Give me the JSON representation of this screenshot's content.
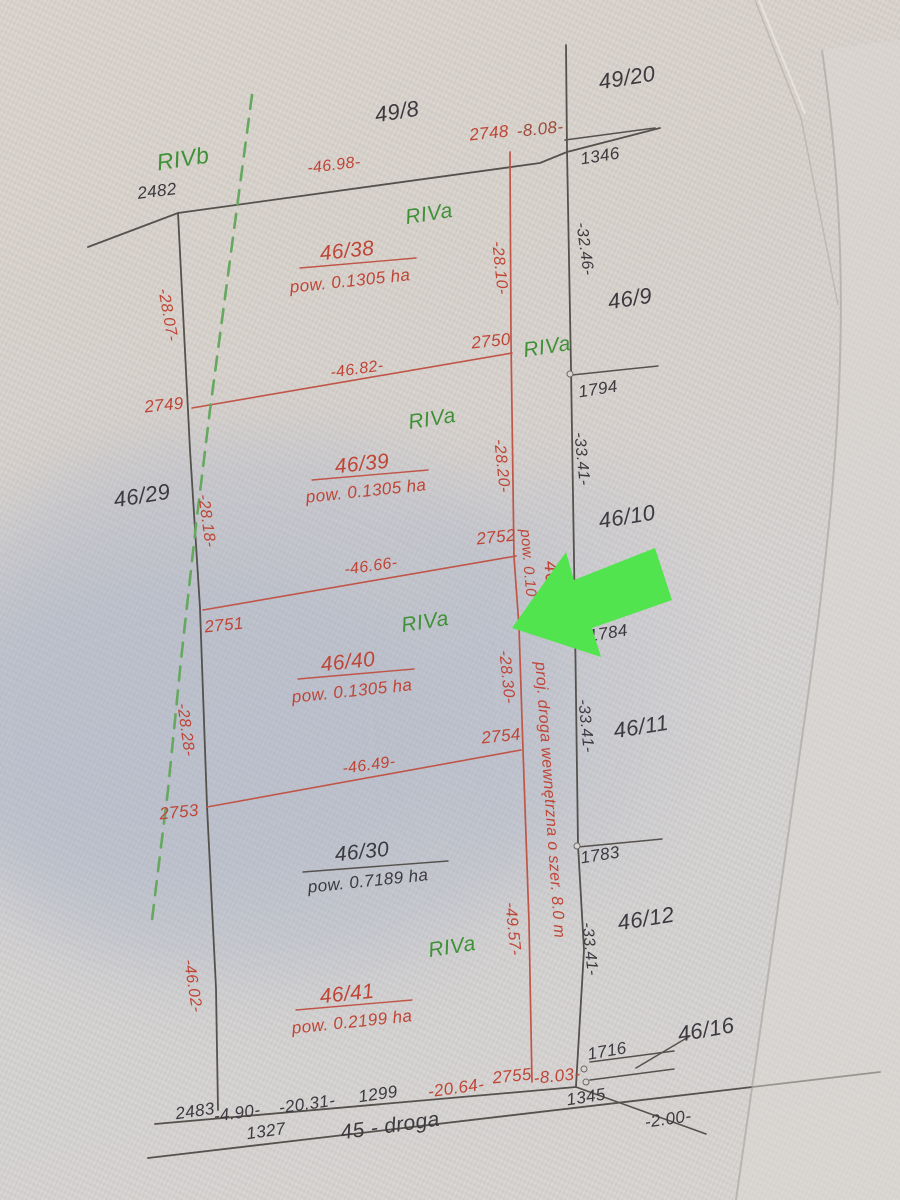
{
  "map": {
    "description": "Photographed cadastral division sketch of parcels 46/38-46/41 along road 45 - droga",
    "colors": {
      "black": "#3c3a40",
      "red": "#bf4536",
      "dkred": "#9e4a3b",
      "green": "#3f9138",
      "lineBlack": "#55514d",
      "lineRed": "#c05548",
      "dashGreen": "#67a861",
      "arrow": "#52e44e",
      "junctionFill": "#d8d4cf",
      "junctionStroke": "#6b6762"
    },
    "labels": [
      {
        "t": "49/20",
        "x": 627,
        "y": 78,
        "r": -9,
        "c": "black",
        "s": 22
      },
      {
        "t": "49/8",
        "x": 397,
        "y": 112,
        "r": -9,
        "c": "black",
        "s": 22
      },
      {
        "t": "2748",
        "x": 489,
        "y": 133,
        "r": -6,
        "c": "red",
        "s": 17
      },
      {
        "t": "-8.08-",
        "x": 540,
        "y": 129,
        "r": -6,
        "c": "dkred",
        "s": 17
      },
      {
        "t": "1346",
        "x": 600,
        "y": 156,
        "r": -9,
        "c": "black",
        "s": 17
      },
      {
        "t": "RIVb",
        "x": 183,
        "y": 159,
        "r": -9,
        "c": "green",
        "s": 23
      },
      {
        "t": "2482",
        "x": 157,
        "y": 191,
        "r": -7,
        "c": "black",
        "s": 17
      },
      {
        "t": "-46.98-",
        "x": 334,
        "y": 166,
        "r": -7,
        "c": "red",
        "s": 16
      },
      {
        "t": "RIVa",
        "x": 429,
        "y": 214,
        "r": -9,
        "c": "green",
        "s": 21
      },
      {
        "t": "46/38",
        "x": 347,
        "y": 251,
        "r": -6,
        "c": "red",
        "s": 21
      },
      {
        "t": "pow. 0.1305 ha",
        "x": 350,
        "y": 281,
        "r": -6,
        "c": "red",
        "s": 17
      },
      {
        "t": "-28.10-",
        "x": 499,
        "y": 268,
        "r": 84,
        "c": "red",
        "s": 16
      },
      {
        "t": "-32.46-",
        "x": 584,
        "y": 249,
        "r": 82,
        "c": "black",
        "s": 16
      },
      {
        "t": "46/9",
        "x": 630,
        "y": 299,
        "r": -9,
        "c": "black",
        "s": 22
      },
      {
        "t": "-28.07-",
        "x": 167,
        "y": 315,
        "r": 80,
        "c": "red",
        "s": 16
      },
      {
        "t": "2750",
        "x": 491,
        "y": 341,
        "r": -6,
        "c": "red",
        "s": 17
      },
      {
        "t": "RIVa",
        "x": 547,
        "y": 347,
        "r": -9,
        "c": "green",
        "s": 21
      },
      {
        "t": "1794",
        "x": 598,
        "y": 389,
        "r": -9,
        "c": "black",
        "s": 17
      },
      {
        "t": "2749",
        "x": 164,
        "y": 405,
        "r": -6,
        "c": "red",
        "s": 17
      },
      {
        "t": "-46.82-",
        "x": 357,
        "y": 370,
        "r": -8,
        "c": "red",
        "s": 16
      },
      {
        "t": "RIVa",
        "x": 432,
        "y": 419,
        "r": -9,
        "c": "green",
        "s": 21
      },
      {
        "t": "46/39",
        "x": 362,
        "y": 464,
        "r": -6,
        "c": "red",
        "s": 21
      },
      {
        "t": "pow. 0.1305 ha",
        "x": 366,
        "y": 491,
        "r": -6,
        "c": "red",
        "s": 17
      },
      {
        "t": "-28.20-",
        "x": 501,
        "y": 466,
        "r": 84,
        "c": "red",
        "s": 16
      },
      {
        "t": "-33.41-",
        "x": 581,
        "y": 459,
        "r": 84,
        "c": "black",
        "s": 16
      },
      {
        "t": "46/29",
        "x": 142,
        "y": 496,
        "r": -9,
        "c": "black",
        "s": 22
      },
      {
        "t": "-28.18-",
        "x": 206,
        "y": 521,
        "r": 82,
        "c": "red",
        "s": 16
      },
      {
        "t": "46/10",
        "x": 627,
        "y": 517,
        "r": -9,
        "c": "black",
        "s": 22
      },
      {
        "t": "2752",
        "x": 496,
        "y": 537,
        "r": -6,
        "c": "red",
        "s": 17
      },
      {
        "t": "pow. 0.10",
        "x": 528,
        "y": 563,
        "r": 85,
        "c": "red",
        "s": 15
      },
      {
        "t": "46/3",
        "x": 552,
        "y": 581,
        "r": 85,
        "c": "red",
        "s": 20
      },
      {
        "t": "-46.66-",
        "x": 371,
        "y": 567,
        "r": -8,
        "c": "red",
        "s": 16
      },
      {
        "t": "2751",
        "x": 224,
        "y": 625,
        "r": -6,
        "c": "red",
        "s": 17
      },
      {
        "t": "1784",
        "x": 608,
        "y": 633,
        "r": -9,
        "c": "black",
        "s": 17
      },
      {
        "t": "RIVa",
        "x": 425,
        "y": 622,
        "r": -9,
        "c": "green",
        "s": 21
      },
      {
        "t": "-28.30-",
        "x": 506,
        "y": 677,
        "r": 84,
        "c": "red",
        "s": 16
      },
      {
        "t": "proj. droga wewnętrzna o szer. 8.0 m",
        "x": 549,
        "y": 800,
        "r": 86,
        "c": "red",
        "s": 16
      },
      {
        "t": "46/40",
        "x": 348,
        "y": 662,
        "r": -6,
        "c": "red",
        "s": 21
      },
      {
        "t": "pow. 0.1305 ha",
        "x": 352,
        "y": 691,
        "r": -6,
        "c": "red",
        "s": 17
      },
      {
        "t": "-28.28-",
        "x": 185,
        "y": 730,
        "r": 82,
        "c": "red",
        "s": 16
      },
      {
        "t": "-33.41-",
        "x": 585,
        "y": 726,
        "r": 84,
        "c": "black",
        "s": 16
      },
      {
        "t": "46/11",
        "x": 641,
        "y": 727,
        "r": -9,
        "c": "black",
        "s": 22
      },
      {
        "t": "2754",
        "x": 501,
        "y": 736,
        "r": -6,
        "c": "red",
        "s": 17
      },
      {
        "t": "-46.49-",
        "x": 369,
        "y": 766,
        "r": -8,
        "c": "red",
        "s": 16
      },
      {
        "t": "2753",
        "x": 179,
        "y": 812,
        "r": -6,
        "c": "red",
        "s": 17
      },
      {
        "t": "46/30",
        "x": 362,
        "y": 852,
        "r": -6,
        "c": "black",
        "s": 21
      },
      {
        "t": "pow. 0.7189 ha",
        "x": 368,
        "y": 881,
        "r": -6,
        "c": "black",
        "s": 17
      },
      {
        "t": "1783",
        "x": 600,
        "y": 855,
        "r": -9,
        "c": "black",
        "s": 17
      },
      {
        "t": "-49.57-",
        "x": 512,
        "y": 929,
        "r": 84,
        "c": "red",
        "s": 16
      },
      {
        "t": "46/12",
        "x": 646,
        "y": 919,
        "r": -9,
        "c": "black",
        "s": 22
      },
      {
        "t": "-33.41-",
        "x": 589,
        "y": 949,
        "r": 84,
        "c": "black",
        "s": 16
      },
      {
        "t": "RIVa",
        "x": 452,
        "y": 947,
        "r": -9,
        "c": "green",
        "s": 21
      },
      {
        "t": "-46.02-",
        "x": 192,
        "y": 986,
        "r": 81,
        "c": "red",
        "s": 16
      },
      {
        "t": "46/41",
        "x": 347,
        "y": 994,
        "r": -6,
        "c": "red",
        "s": 21
      },
      {
        "t": "pow. 0.2199 ha",
        "x": 352,
        "y": 1022,
        "r": -6,
        "c": "red",
        "s": 17
      },
      {
        "t": "1716",
        "x": 607,
        "y": 1051,
        "r": -10,
        "c": "black",
        "s": 17
      },
      {
        "t": "46/16",
        "x": 706,
        "y": 1030,
        "r": -10,
        "c": "black",
        "s": 22
      },
      {
        "t": "2755",
        "x": 512,
        "y": 1076,
        "r": -6,
        "c": "red",
        "s": 17
      },
      {
        "t": "-8.03-",
        "x": 557,
        "y": 1076,
        "r": -6,
        "c": "red",
        "s": 17
      },
      {
        "t": "1345",
        "x": 586,
        "y": 1097,
        "r": -9,
        "c": "black",
        "s": 17
      },
      {
        "t": "-20.64-",
        "x": 456,
        "y": 1088,
        "r": -8,
        "c": "red",
        "s": 17
      },
      {
        "t": "1299",
        "x": 378,
        "y": 1094,
        "r": -8,
        "c": "black",
        "s": 17
      },
      {
        "t": "-20.31-",
        "x": 307,
        "y": 1104,
        "r": -8,
        "c": "black",
        "s": 17
      },
      {
        "t": "-4.90-",
        "x": 237,
        "y": 1113,
        "r": -8,
        "c": "black",
        "s": 17
      },
      {
        "t": "2483",
        "x": 195,
        "y": 1111,
        "r": -8,
        "c": "black",
        "s": 17
      },
      {
        "t": "1327",
        "x": 266,
        "y": 1131,
        "r": -8,
        "c": "black",
        "s": 17
      },
      {
        "t": "45 - droga",
        "x": 390,
        "y": 1126,
        "r": -8,
        "c": "black",
        "s": 21
      },
      {
        "t": "-2.00-",
        "x": 668,
        "y": 1119,
        "r": -8,
        "c": "black",
        "s": 17
      }
    ],
    "lines": [
      {
        "n": "north-boundary-line",
        "c": "lineBlack",
        "w": 1.8,
        "pts": [
          [
            88,
            247
          ],
          [
            178,
            213
          ],
          [
            540,
            163
          ],
          [
            567,
            152
          ],
          [
            660,
            128
          ]
        ]
      },
      {
        "n": "west-boundary-line",
        "c": "lineBlack",
        "w": 1.8,
        "pts": [
          [
            178,
            213
          ],
          [
            190,
            450
          ],
          [
            200,
            608
          ],
          [
            207,
            806
          ],
          [
            216,
            988
          ],
          [
            218,
            1110
          ]
        ]
      },
      {
        "n": "east-boundary-line",
        "c": "lineBlack",
        "w": 1.8,
        "pts": [
          [
            566,
            45
          ],
          [
            567,
            150
          ],
          [
            571,
            368
          ],
          [
            575,
            623
          ],
          [
            578,
            845
          ],
          [
            584,
            950
          ],
          [
            576,
            1086
          ]
        ]
      },
      {
        "n": "tick-line-1346",
        "c": "lineBlack",
        "w": 1.5,
        "pts": [
          [
            565,
            140
          ],
          [
            655,
            128
          ]
        ]
      },
      {
        "n": "tick-line-1794",
        "c": "lineBlack",
        "w": 1.5,
        "pts": [
          [
            572,
            375
          ],
          [
            658,
            366
          ]
        ]
      },
      {
        "n": "tick-line-1783",
        "c": "lineBlack",
        "w": 1.5,
        "pts": [
          [
            578,
            847
          ],
          [
            662,
            839
          ]
        ]
      },
      {
        "n": "road-upper-edge",
        "c": "lineBlack",
        "w": 1.8,
        "pts": [
          [
            155,
            1124
          ],
          [
            576,
            1087
          ]
        ]
      },
      {
        "n": "road-lower-edge",
        "c": "lineBlack",
        "w": 1.8,
        "pts": [
          [
            148,
            1158
          ],
          [
            880,
            1072
          ]
        ]
      },
      {
        "n": "segment-2-00",
        "c": "lineBlack",
        "w": 1.6,
        "pts": [
          [
            576,
            1087
          ],
          [
            706,
            1134
          ]
        ]
      },
      {
        "n": "leader-46-16",
        "c": "lineBlack",
        "w": 1.5,
        "pts": [
          [
            636,
            1068
          ],
          [
            690,
            1036
          ]
        ]
      },
      {
        "n": "tick-line-1716-a",
        "c": "lineBlack",
        "w": 1.5,
        "pts": [
          [
            590,
            1062
          ],
          [
            674,
            1051
          ]
        ]
      },
      {
        "n": "tick-line-1716-b",
        "c": "lineBlack",
        "w": 1.5,
        "pts": [
          [
            590,
            1080
          ],
          [
            674,
            1069
          ]
        ]
      },
      {
        "n": "fraction-bar-46-30",
        "c": "lineBlack",
        "w": 1.4,
        "pts": [
          [
            303,
            872
          ],
          [
            448,
            861
          ]
        ]
      },
      {
        "n": "division-road-line",
        "c": "lineRed",
        "w": 1.7,
        "pts": [
          [
            510,
            152
          ],
          [
            511,
            340
          ],
          [
            514,
            557
          ],
          [
            519,
            627
          ],
          [
            523,
            750
          ],
          [
            529,
            922
          ],
          [
            532,
            1082
          ]
        ]
      },
      {
        "n": "division-line-46-82",
        "c": "lineRed",
        "w": 1.6,
        "pts": [
          [
            192,
            408
          ],
          [
            512,
            353
          ]
        ]
      },
      {
        "n": "division-line-46-66",
        "c": "lineRed",
        "w": 1.6,
        "pts": [
          [
            203,
            610
          ],
          [
            516,
            556
          ]
        ]
      },
      {
        "n": "division-line-46-49",
        "c": "lineRed",
        "w": 1.6,
        "pts": [
          [
            207,
            807
          ],
          [
            521,
            750
          ]
        ]
      },
      {
        "n": "fraction-bar-46-38",
        "c": "lineRed",
        "w": 1.4,
        "pts": [
          [
            300,
            268
          ],
          [
            416,
            258
          ]
        ]
      },
      {
        "n": "fraction-bar-46-39",
        "c": "lineRed",
        "w": 1.4,
        "pts": [
          [
            312,
            480
          ],
          [
            428,
            470
          ]
        ]
      },
      {
        "n": "fraction-bar-46-40",
        "c": "lineRed",
        "w": 1.4,
        "pts": [
          [
            298,
            679
          ],
          [
            414,
            669
          ]
        ]
      },
      {
        "n": "fraction-bar-46-41",
        "c": "lineRed",
        "w": 1.4,
        "pts": [
          [
            296,
            1010
          ],
          [
            412,
            1000
          ]
        ]
      },
      {
        "n": "soil-class-dashed-line",
        "c": "dashGreen",
        "w": 2.6,
        "d": "14 10",
        "pts": [
          [
            252,
            95
          ],
          [
            230,
            260
          ],
          [
            210,
            410
          ],
          [
            196,
            525
          ],
          [
            181,
            660
          ],
          [
            168,
            790
          ],
          [
            152,
            920
          ]
        ]
      }
    ],
    "junctions": [
      {
        "x": 570,
        "y": 374
      },
      {
        "x": 577,
        "y": 846
      },
      {
        "x": 584,
        "y": 1069
      },
      {
        "x": 586,
        "y": 1082
      }
    ],
    "arrow": {
      "name": "green-highlight-arrow",
      "points": [
        [
          512,
          628
        ],
        [
          566,
          552
        ],
        [
          574,
          580
        ],
        [
          655,
          548
        ],
        [
          672,
          600
        ],
        [
          592,
          628
        ],
        [
          601,
          657
        ]
      ]
    }
  }
}
